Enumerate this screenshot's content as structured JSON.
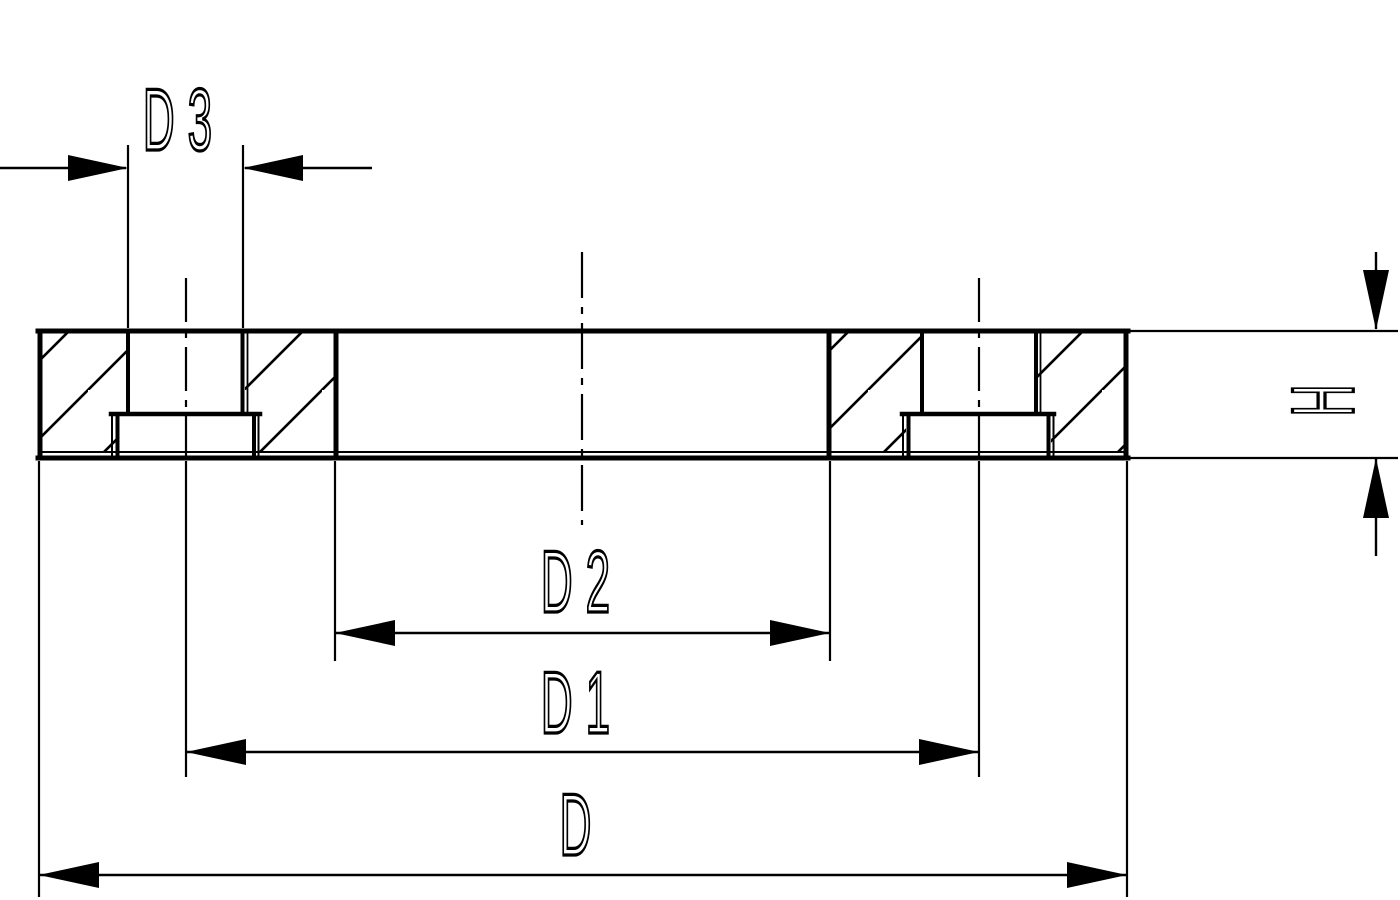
{
  "drawing": {
    "colors": {
      "line": "#000000",
      "background": "#ffffff"
    },
    "dimensions": {
      "d3": {
        "label": "D3"
      },
      "h": {
        "label": "H"
      },
      "d2": {
        "label": "D2"
      },
      "d1": {
        "label": "D1"
      },
      "d": {
        "label": "D"
      }
    }
  }
}
